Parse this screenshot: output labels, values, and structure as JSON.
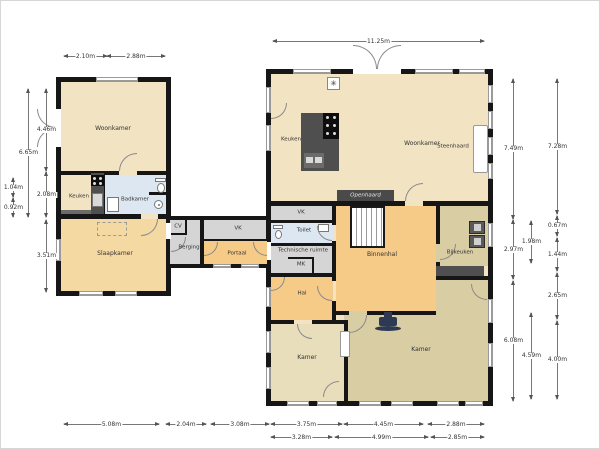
{
  "rooms": {
    "left_woonkamer": "Woonkamer",
    "left_keuken": "Keuken",
    "left_badkamer": "Badkamer",
    "left_slaapkamer": "Slaapkamer",
    "cv": "CV",
    "berging": "Berging",
    "vk_left": "VK",
    "portaal": "Portaal",
    "right_keuken": "Keuken",
    "right_woonkamer": "Woonkamer",
    "steenhaard": "Steenhaard",
    "openhaard": "Openhaard",
    "vk_right": "VK",
    "toilet": "Toilet",
    "technische_ruimte": "Technische ruimte",
    "mk": "MK",
    "binnenhal": "Binnenhal",
    "bijkeuken": "Bijkeuken",
    "hal": "Hal",
    "kamer_small": "Kamer",
    "kamer_large": "Kamer"
  },
  "dims": {
    "top_left_a": "2.10m",
    "top_left_b": "2.88m",
    "top_right": "11.25m",
    "left_small_a": "1.04m",
    "left_small_b": "0.92m",
    "left_outer": "6.65m",
    "left_inner_a": "4.46m",
    "left_inner_b": "2.08m",
    "left_inner_c": "3.51m",
    "right_inner_a": "7.49m",
    "right_inner_b": "2.97m",
    "right_inner_c": "6.08m",
    "right_mid_a": "1.98m",
    "right_mid_b": "4.59m",
    "right_outer_a": "7.28m",
    "right_outer_b": "0.67m",
    "right_outer_c": "1.44m",
    "right_outer_d": "2.65m",
    "right_outer_e": "4.00m",
    "bottom_a": "5.08m",
    "bottom_b": "2.04m",
    "bottom_c": "3.08m",
    "bottom_d": "3.75m",
    "bottom_e": "4.45m",
    "bottom_f": "2.88m",
    "bottom2_a": "3.28m",
    "bottom2_b": "4.99m",
    "bottom2_c": "2.85m"
  },
  "symbols": {
    "vent": "✳"
  },
  "colors": {
    "wall": "#161616",
    "tan": "#f2e3c2",
    "peach": "#f4d9a2",
    "orange": "#f6ca87",
    "khaki": "#d8cda3",
    "light_khaki": "#e8debb",
    "blue": "#dde7f2",
    "gray": "#d5d5d5",
    "furniture": "#4f4f4f",
    "stove_blue": "#2e3a54"
  }
}
